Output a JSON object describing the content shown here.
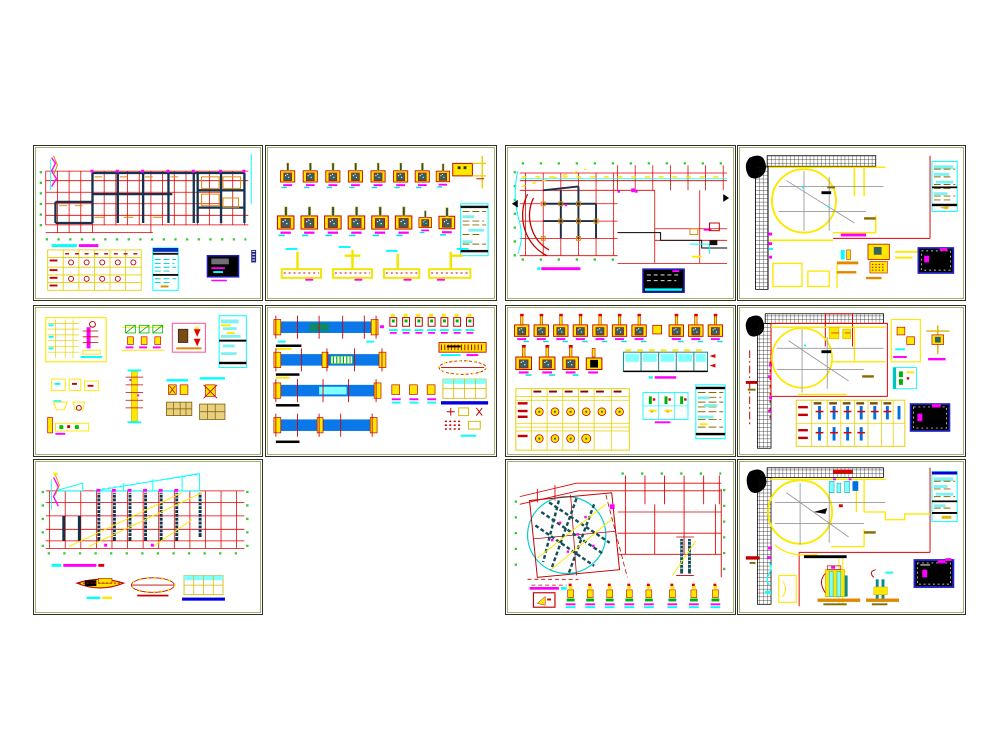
{
  "page": {
    "background": "#ffffff"
  },
  "palette": {
    "sheet_border_outer": "#2f2f2f",
    "sheet_border_inner": "#9fb36b",
    "grid_red": "#e00000",
    "dark_red": "#c00000",
    "yellow": "#ffe800",
    "pale_yellow_line": "#d8b800",
    "cyan": "#00ffff",
    "cyan_fill": "#7ef2f2",
    "teal_core": "#3a5f5f",
    "dark_teal_beam": "#14505a",
    "magenta": "#ff00ff",
    "beam_blue": "#0a78e8",
    "navy_titleblock": "#2020c0",
    "underline_blue": "#0000dd",
    "green_bubble": "#33cc33",
    "detail_green": "#00b000",
    "gray_grid": "#999999",
    "orange": "#e08800",
    "tan_text": "#8a6a00",
    "hatch_black": "#111111",
    "wall_dark": "#16324f"
  },
  "sheets": [
    {
      "id": "s1",
      "name": "floor-framing-plan-sheet"
    },
    {
      "id": "s2",
      "name": "column-pier-details-sheet"
    },
    {
      "id": "s3",
      "name": "curved-wing-framing-plan-sheet"
    },
    {
      "id": "s4",
      "name": "foundation-plan-sheet"
    },
    {
      "id": "s5",
      "name": "misc-structural-details-sheet"
    },
    {
      "id": "s6",
      "name": "beam-elevation-details-sheet"
    },
    {
      "id": "s7",
      "name": "column-schedule-sheet"
    },
    {
      "id": "s8",
      "name": "foundation-plan-with-schedule-sheet"
    },
    {
      "id": "s9",
      "name": "roof-truss-framing-sheet"
    },
    {
      "id": "s10",
      "name": "curved-roof-plan-sheet"
    },
    {
      "id": "s11",
      "name": "foundation-details-sheet"
    }
  ]
}
